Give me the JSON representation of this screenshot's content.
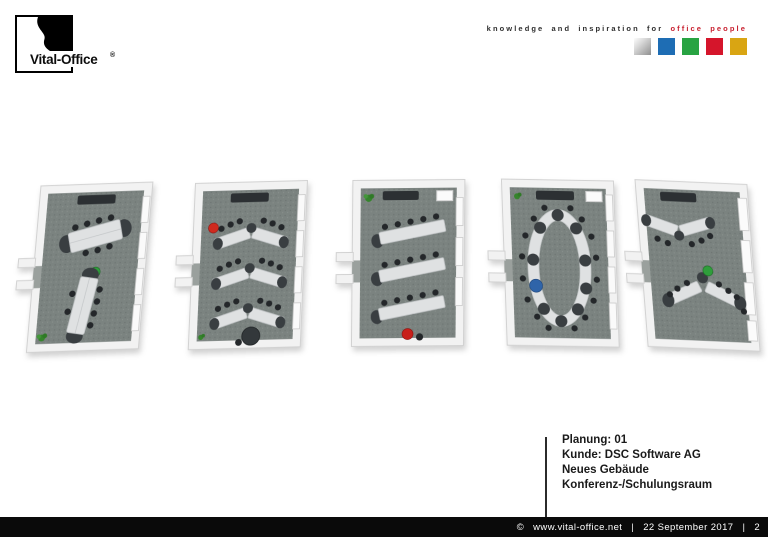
{
  "header": {
    "logo": {
      "brand": "Vital-Office",
      "registered": "®"
    },
    "tagline": {
      "prefix": "knowledge and inspiration for",
      "highlight": "office people",
      "highlight_color": "#c8202f"
    },
    "squares": [
      {
        "name": "silver",
        "color": "#b9b9b9"
      },
      {
        "name": "blue",
        "color": "#1e6db4"
      },
      {
        "name": "green",
        "color": "#28a342"
      },
      {
        "name": "red",
        "color": "#d5152b"
      },
      {
        "name": "gold",
        "color": "#d9a513"
      }
    ]
  },
  "plans": [
    {
      "name": "two-parallel-table-groups",
      "accent": "#2f9e3b"
    },
    {
      "name": "chevron-rows",
      "accent": "#d02a1e"
    },
    {
      "name": "straight-rows",
      "accent": "#c81f1a"
    },
    {
      "name": "oval-conference",
      "accent": "#2f64a9"
    },
    {
      "name": "double-v-arrangement",
      "accent": "#2f9e3b"
    }
  ],
  "project": {
    "lines": [
      "Planung: 01",
      "Kunde: DSC Software AG",
      "Neues Gebäude",
      "Konferenz-/Schulungsraum"
    ]
  },
  "footer": {
    "copyright": "©",
    "url": "www.vital-office.net",
    "sep": "|",
    "date": "22 September 2017",
    "page": "2"
  }
}
